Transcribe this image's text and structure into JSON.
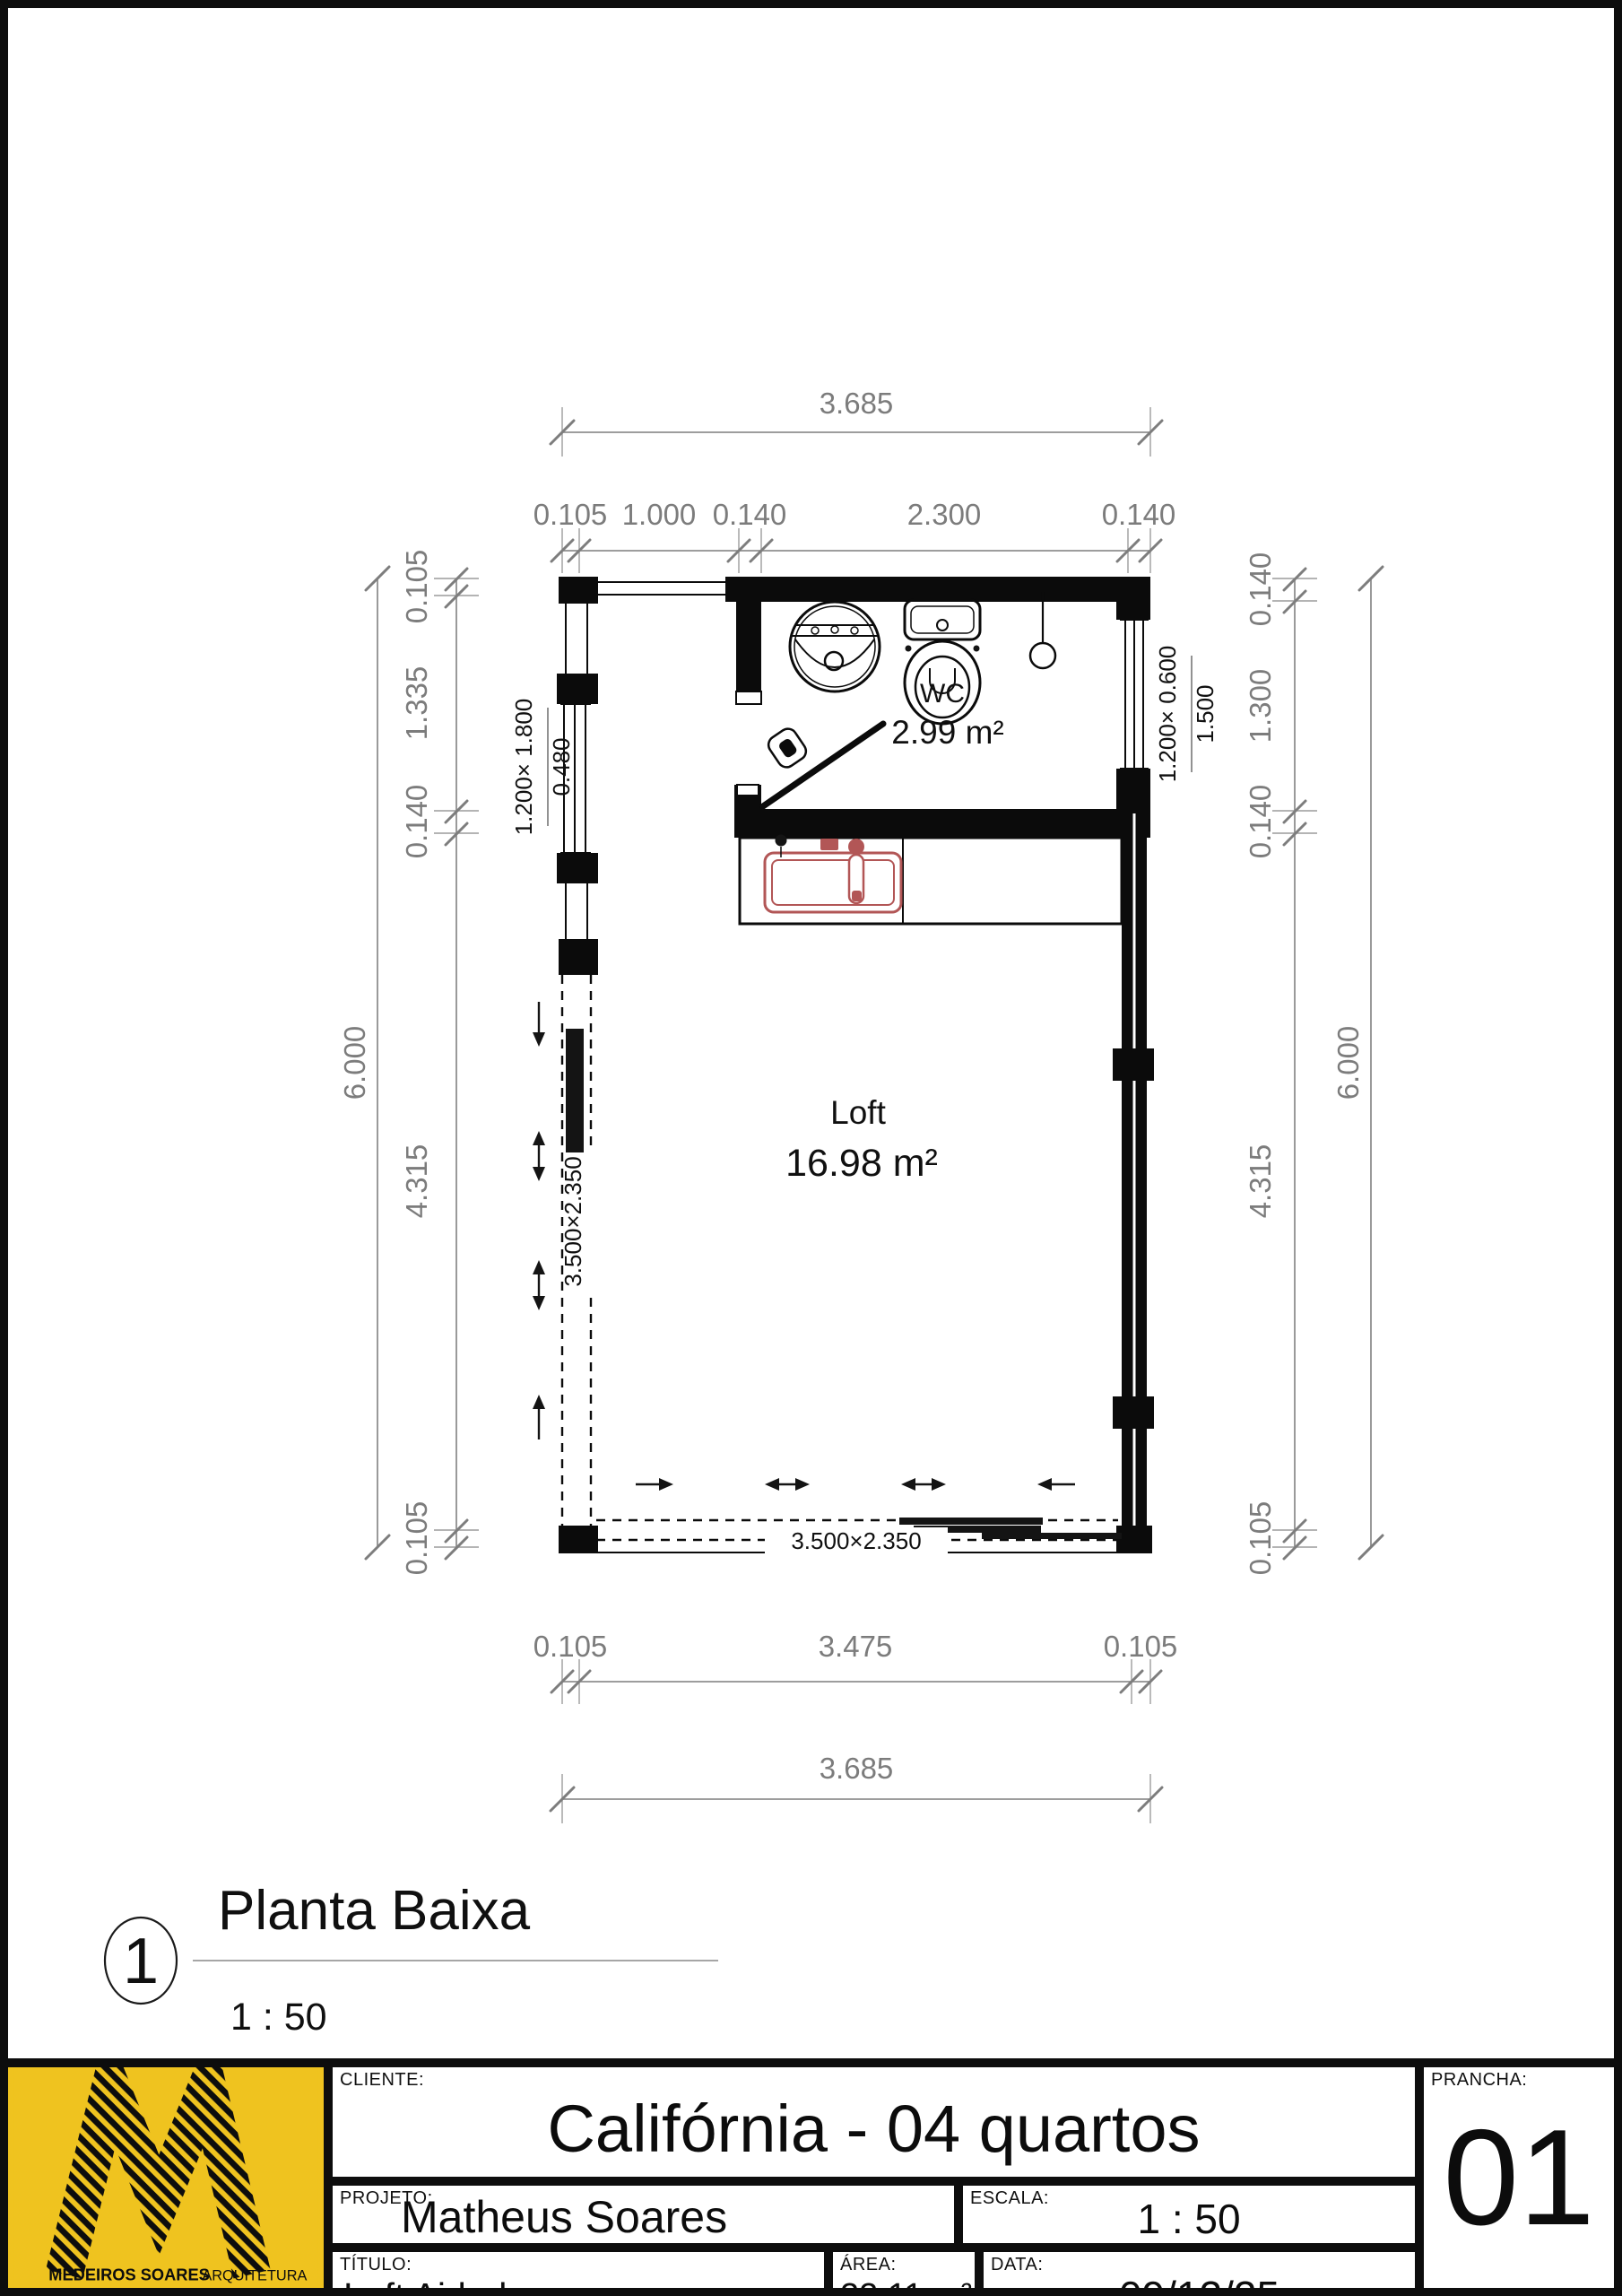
{
  "plan": {
    "dims": {
      "top": {
        "overall": "3.685",
        "chain": [
          "0.105",
          "1.000",
          "0.140",
          "2.300",
          "0.140"
        ]
      },
      "bottom": {
        "overall": "3.685",
        "chain": [
          "0.105",
          "3.475",
          "0.105"
        ]
      },
      "left": {
        "overall": "6.000",
        "chain": [
          "0.105",
          "1.335",
          "0.140",
          "4.315",
          "0.105"
        ]
      },
      "right": {
        "overall": "6.000",
        "chain": [
          "0.140",
          "1.300",
          "0.140",
          "4.315",
          "0.105"
        ]
      }
    },
    "rooms": {
      "wc": {
        "name": "WC",
        "area": "2.99 m²"
      },
      "loft": {
        "name": "Loft",
        "area": "16.98 m²"
      }
    },
    "openings": {
      "left_window": {
        "size": "1.200× 1.800",
        "sill": "0.480"
      },
      "right_window": {
        "size": "1.200× 0.600",
        "sill": "1.500"
      },
      "left_sliding_door": {
        "size": "3.500×2.350"
      },
      "bottom_sliding_door": {
        "size": "3.500×2.350"
      }
    }
  },
  "view": {
    "number": "1",
    "title": "Planta Baixa",
    "scale": "1 : 50"
  },
  "tb": {
    "cliente": {
      "label": "CLIENTE:",
      "value": "Califórnia - 04 quartos"
    },
    "projeto": {
      "label": "PROJETO:",
      "value": "Matheus Soares"
    },
    "escala": {
      "label": "ESCALA:",
      "value": "1 : 50"
    },
    "titulo": {
      "label": "TÍTULO:",
      "value": "Loft Airbnb"
    },
    "area": {
      "label": "ÁREA:",
      "value": "22,11 m²"
    },
    "data": {
      "label": "DATA:",
      "value": "09/12/25"
    },
    "prancha": {
      "label": "PRANCHA:",
      "value": "01"
    },
    "logo": {
      "name": "MEDEIROS SOARES",
      "field": "ARQUITETURA"
    }
  },
  "colors": {
    "logo_yellow": "#efc31f",
    "sink_red": "#b25656",
    "dim_gray": "#7c7c7c"
  }
}
